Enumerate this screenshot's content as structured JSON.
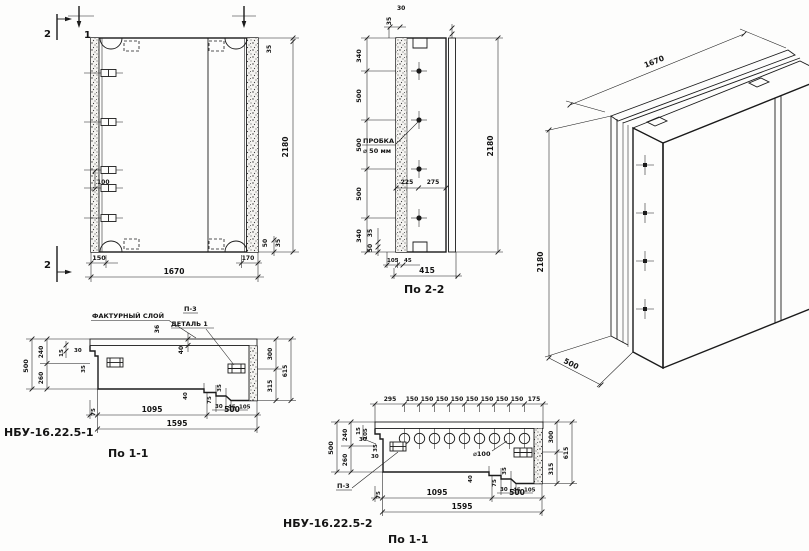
{
  "front": {
    "marker_1": "1",
    "marker_2_top": "2",
    "marker_2_bottom": "2",
    "dim_plug_gap": "100",
    "dim_150": "150",
    "dim_1670": "1670",
    "dim_2180": "2180",
    "dim_35_top": "35",
    "dim_50_bottom": "50",
    "dim_35_bottom": "35",
    "dim_170": "170"
  },
  "sec22": {
    "title": "По 2-2",
    "plug_label_line1": "ПРОБКА",
    "plug_label_line2": "⌀ 50 мм",
    "dim_30_top": "30",
    "dim_35_top": "35",
    "dim_340_top": "340",
    "dim_500_a": "500",
    "dim_500_b": "500",
    "dim_500_c": "500",
    "dim_340_bottom": "340",
    "dim_2180": "2180",
    "dim_225": "225",
    "dim_275": "275",
    "dim_35_bottom": "35",
    "dim_50_bottom": "50",
    "dim_105": "105",
    "dim_45": "45",
    "dim_415": "415"
  },
  "iso": {
    "dim_1670": "1670",
    "dim_2180": "2180",
    "dim_500": "500"
  },
  "p1": {
    "panel_label": "НБУ-16.22.5-1",
    "title": "По 1-1",
    "facing_label": "ФАКТУРНЫЙ СЛОЙ",
    "p3_label": "П-3",
    "detail_label": "ДЕТАЛЬ 1",
    "dim_36": "36",
    "dim_40": "40",
    "dim_500_left": "500",
    "dim_240": "240",
    "dim_260": "260",
    "dim_15": "15",
    "dim_30": "30",
    "dim_35": "35",
    "dim_300": "300",
    "dim_315": "315",
    "dim_615": "615",
    "step_40": "40",
    "step_35": "35",
    "step_75": "75",
    "step_30": "30",
    "step_45": "45",
    "step_105": "105",
    "dim_75": "75",
    "dim_1095": "1095",
    "dim_500_bottom": "500",
    "dim_1595": "1595"
  },
  "p2": {
    "panel_label": "НБУ-16.22.5-2",
    "title": "По 1-1",
    "p3_label": "П-3",
    "hole_label": "⌀100",
    "top_dims": [
      "295",
      "150",
      "150",
      "150",
      "150",
      "150",
      "150",
      "150",
      "150",
      "175"
    ],
    "dim_500_left": "500",
    "dim_240": "240",
    "dim_260": "260",
    "dim_15": "15",
    "dim_105_small": "105",
    "dim_30_a": "30",
    "dim_35": "35",
    "dim_30_b": "30",
    "dim_300": "300",
    "dim_315": "315",
    "dim_615": "615",
    "step_40": "40",
    "step_35": "35",
    "step_75": "75",
    "step_30": "30",
    "step_45": "45",
    "step_105": "105",
    "dim_75": "75",
    "dim_1095": "1095",
    "dim_500_bottom": "500",
    "dim_1595": "1595"
  }
}
